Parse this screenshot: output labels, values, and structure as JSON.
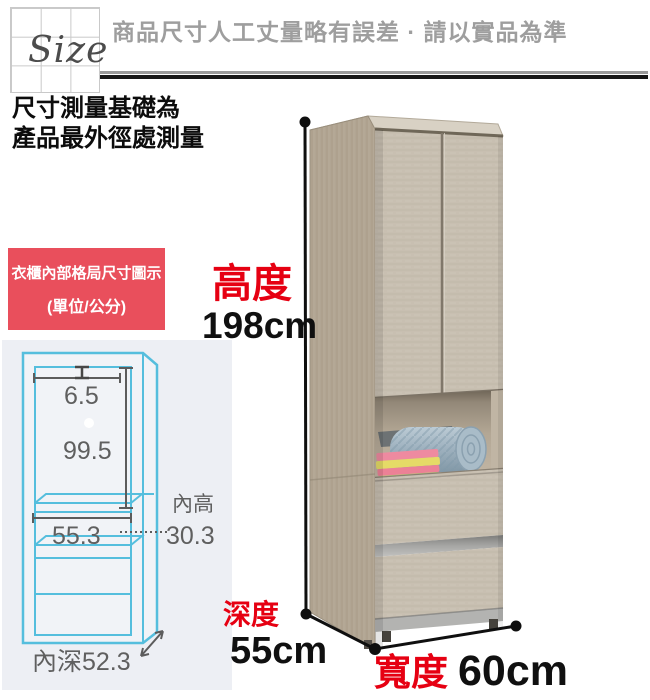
{
  "header": {
    "size_label": "Size",
    "disclaimer": "商品尺寸人工丈量略有誤差 · 請以實品為準"
  },
  "measure_note": {
    "line1": "尺寸測量基礎為",
    "line2": "產品最外徑處測量"
  },
  "interior_panel": {
    "title": "衣櫃內部格局尺寸圖示",
    "unit_note": "(單位/公分)",
    "title_bg_color": "#e94f5c",
    "panel_bg_color": "#edeff4",
    "diagram": {
      "line_color": "#55bedd",
      "text_color": "#5f5f5f",
      "top_gap": "6.5",
      "hanging_height": "99.5",
      "inner_width": "55.3",
      "inner_height_label": "內高",
      "inner_height": "30.3",
      "inner_depth": "內深52.3"
    }
  },
  "dimensions": {
    "accent_red": "#e60012",
    "height_label": "高度",
    "height_value": "198cm",
    "depth_label": "深度",
    "depth_value": "55cm",
    "width_label": "寬度",
    "width_value": "60cm"
  }
}
